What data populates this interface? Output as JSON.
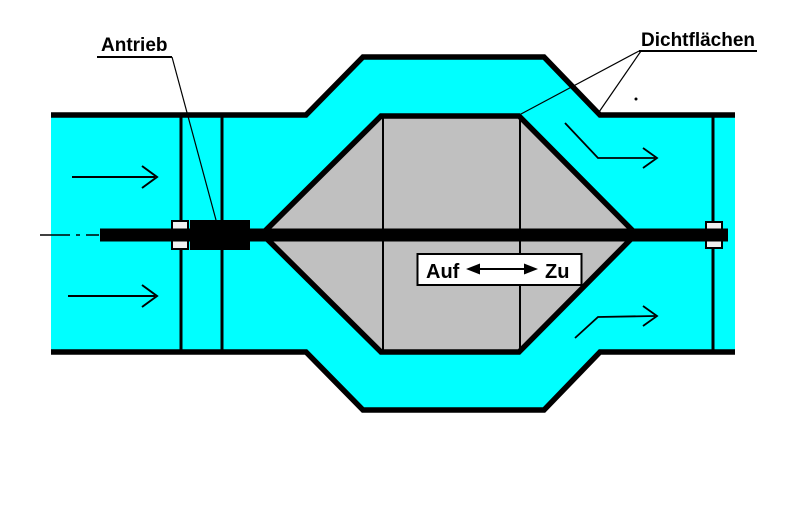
{
  "labels": {
    "actuator": "Antrieb",
    "sealing_surfaces": "Dichtflächen"
  },
  "indicator": {
    "open": "Auf",
    "close": "Zu"
  },
  "colors": {
    "fluid": "#00FFFF",
    "valve_body": "#C0C0C0",
    "outline": "#000000",
    "background": "#FFFFFF"
  },
  "icons": {
    "flow_arrow": "flow-direction-arrow",
    "open_close_arrow": "double-headed-arrow",
    "centerline": "dash-dot-centerline"
  }
}
